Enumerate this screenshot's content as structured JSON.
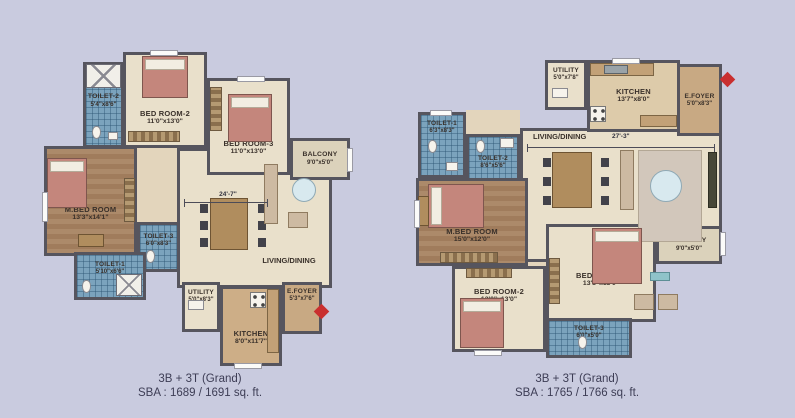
{
  "page": {
    "background": "#c9cbdf",
    "wall_color": "#56555e",
    "tile_color": "#7ba3bd",
    "accent_red": "#c92f2f"
  },
  "plan_left": {
    "rooms": {
      "toilet2": {
        "name": "TOILET-2",
        "dims": "5'4\"x8'6\""
      },
      "bedroom2": {
        "name": "BED ROOM-2",
        "dims": "11'0\"x13'0\""
      },
      "bedroom3": {
        "name": "BED ROOM-3",
        "dims": "11'0\"x13'0\""
      },
      "balcony": {
        "name": "BALCONY",
        "dims": "9'0\"x5'0\""
      },
      "mbedroom": {
        "name": "M.BED ROOM",
        "dims": "13'3\"x14'1\""
      },
      "toilet3": {
        "name": "TOILET-3",
        "dims": "6'0\"x8'3\""
      },
      "toilet1": {
        "name": "TOILET-1",
        "dims": "5'10\"x6'6\""
      },
      "living": {
        "name": "LIVING/DINING",
        "dim": "24'-7\""
      },
      "utility": {
        "name": "UTILITY",
        "dims": "5'0\"x8'3\""
      },
      "kitchen": {
        "name": "KITCHEN",
        "dims": "8'0\"x11'7\""
      },
      "efoyer": {
        "name": "E.FOYER",
        "dims": "5'3\"x7'6\""
      }
    },
    "caption": {
      "line1": "3B + 3T (Grand)",
      "line2": "SBA : 1689 / 1691 sq. ft."
    }
  },
  "plan_right": {
    "rooms": {
      "utility": {
        "name": "UTILITY",
        "dims": "5'0\"x7'8\""
      },
      "kitchen": {
        "name": "KITCHEN",
        "dims": "13'7\"x8'0\""
      },
      "efoyer": {
        "name": "E.FOYER",
        "dims": "5'0\"x8'3\""
      },
      "toilet1": {
        "name": "TOILET-1",
        "dims": "6'3\"x8'3\""
      },
      "toilet2": {
        "name": "TOILET-2",
        "dims": "8'6\"x5'6\""
      },
      "living": {
        "name": "LIVING/DINING",
        "dim": "27'-3\""
      },
      "mbedroom": {
        "name": "M.BED ROOM",
        "dims": "15'0\"x12'0\""
      },
      "balcony": {
        "name": "BALCONY",
        "dims": "9'0\"x5'0\""
      },
      "bedroom2": {
        "name": "BED ROOM-2",
        "dims": "12'0\"x13'0\""
      },
      "bedroom3": {
        "name": "BED ROOM-3",
        "dims": "13'8\"x13'0\""
      },
      "toilet3": {
        "name": "TOILET-3",
        "dims": "6'0\"x5'0\""
      }
    },
    "caption": {
      "line1": "3B + 3T (Grand)",
      "line2": "SBA : 1765 / 1766 sq. ft."
    }
  }
}
